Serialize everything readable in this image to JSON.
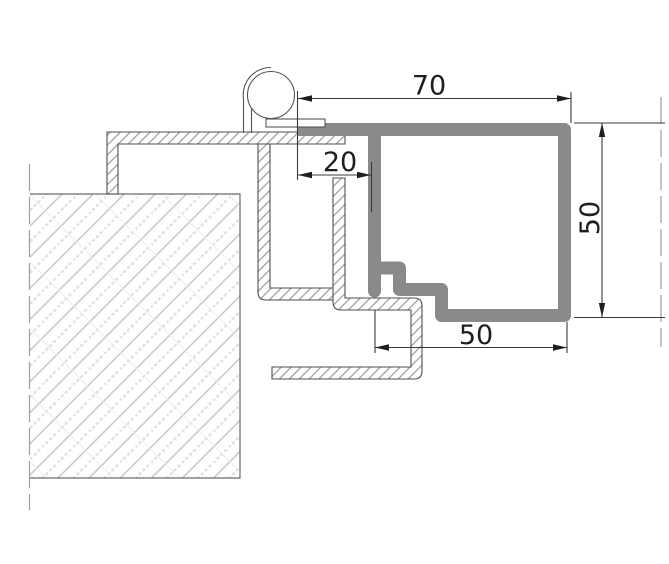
{
  "drawing": {
    "kind": "technical-section",
    "description": "steel door frame cross-section detail with hinge roller, wall and leaf profiles",
    "dimensions": {
      "top_width": {
        "value": "70"
      },
      "hinge_offset": {
        "value": "20"
      },
      "profile_height": {
        "value": "50"
      },
      "bottom_width": {
        "value": "50"
      }
    },
    "colors": {
      "background": "#ffffff",
      "frame_profile": "#8a8a8a",
      "thin_outline": "#4f4f4f",
      "steel_hatch": "#9a9a9a",
      "wall_hatch_line": "#c6c6c6",
      "wall_hatch_dots": "#e0e0e0",
      "wall_cross_line": "#ececec",
      "wall_outline": "#6a6a6a",
      "dimension_line": "#3a3a3a",
      "dimension_text": "#1e1e1e",
      "centerline": "#9e9e9e",
      "hinge_outline": "#555555"
    }
  }
}
